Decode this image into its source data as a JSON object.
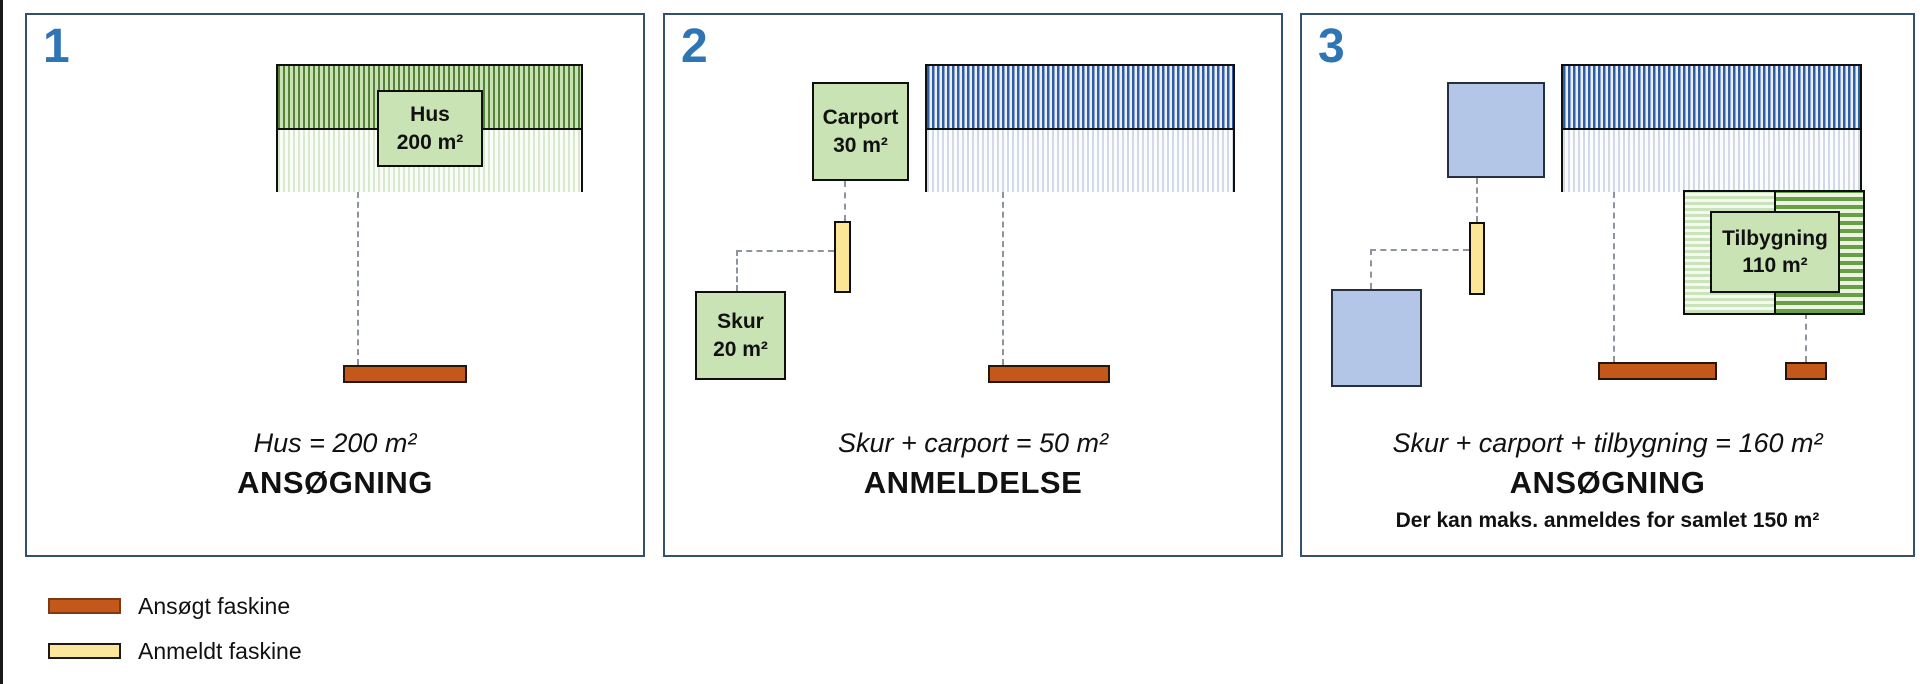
{
  "panels": [
    {
      "number": "1",
      "hus_label": {
        "name": "Hus",
        "area": "200 m²"
      },
      "caption": {
        "formula": "Hus = 200 m²",
        "status": "ANSØGNING"
      }
    },
    {
      "number": "2",
      "carport_label": {
        "name": "Carport",
        "area": "30 m²"
      },
      "skur_label": {
        "name": "Skur",
        "area": "20 m²"
      },
      "caption": {
        "formula": "Skur + carport = 50 m²",
        "status": "ANMELDELSE"
      }
    },
    {
      "number": "3",
      "tilbygning_label": {
        "name": "Tilbygning",
        "area": "110 m²"
      },
      "caption": {
        "formula": "Skur + carport + tilbygning = 160 m²",
        "status": "ANSØGNING",
        "note": "Der kan maks. anmeldes for samlet 150 m²"
      }
    }
  ],
  "legend": {
    "items": [
      {
        "label": "Ansøgt faskine",
        "swatch_color": "#C4581A",
        "swatch_border": "#7E3A12"
      },
      {
        "label": "Anmeldt faskine",
        "swatch_color": "#FCE69C",
        "swatch_border": "#1A1A1A"
      }
    ]
  },
  "colors": {
    "panel_border": "#33506E",
    "panel_number": "#2E75B6",
    "label_box_green": "#C9E3B4",
    "blue_square": "#B3C6E7",
    "ansogt_faskine_orange": "#C4581A",
    "anmeldt_faskine_yellow": "#FCE69C",
    "green_stripe": "#56813A",
    "blue_stripe": "#2F5EA4",
    "tilbygning_stripe": "#68A143"
  }
}
